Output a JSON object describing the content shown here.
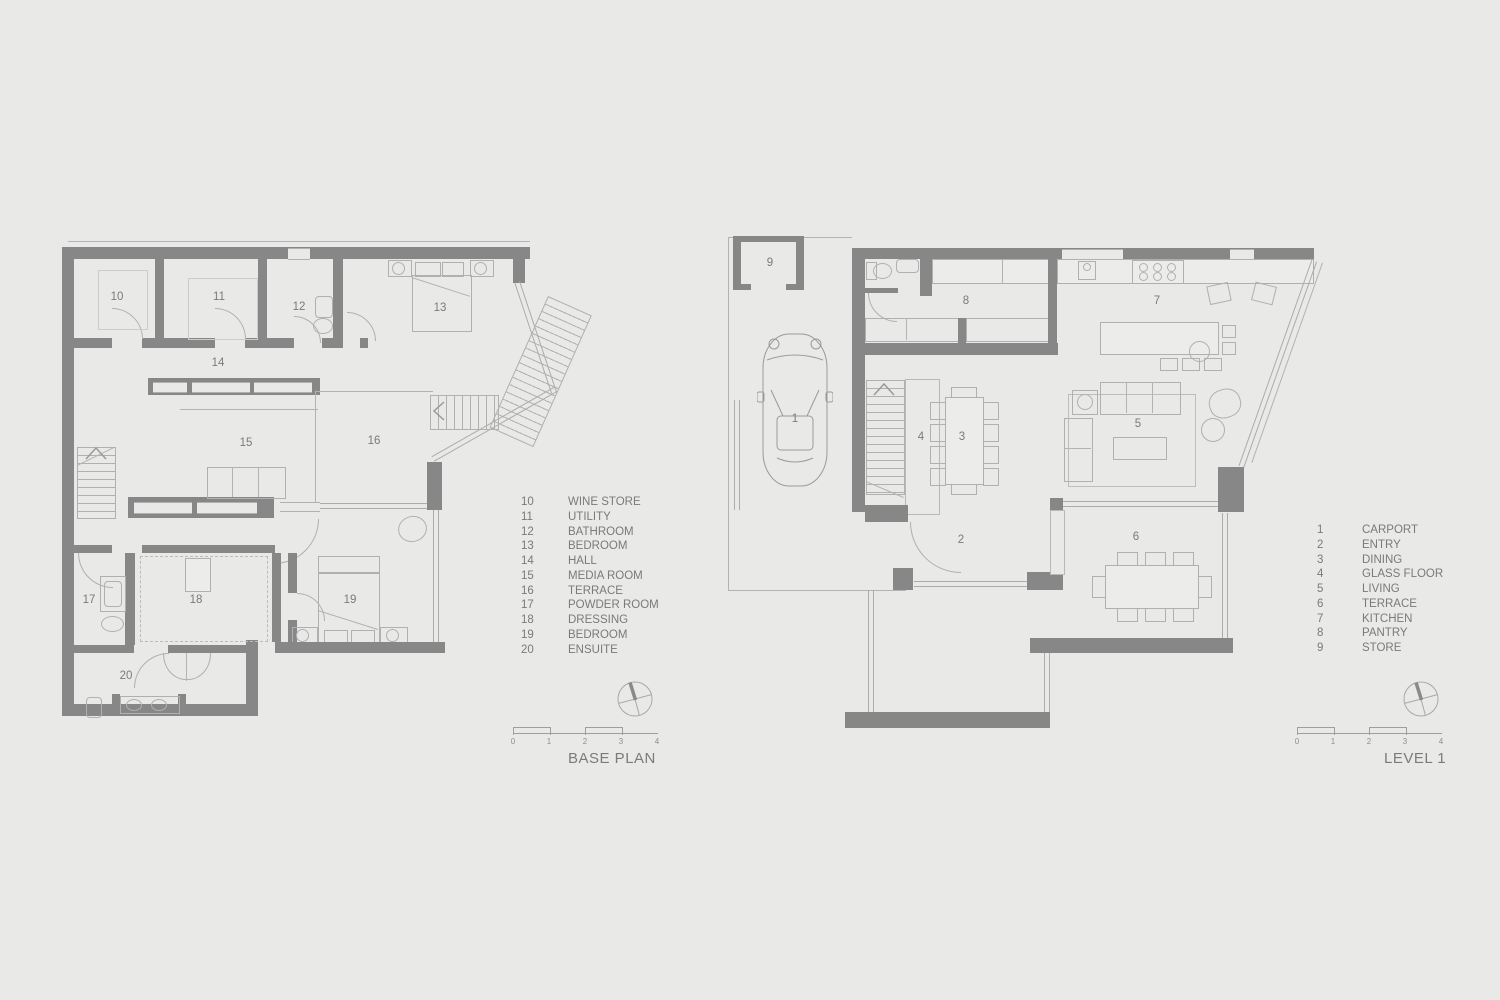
{
  "colors": {
    "background": "#e9e9e8",
    "wall": "#878787",
    "line": "#b0b0b0",
    "text": "#7a7a7a"
  },
  "plans": [
    {
      "title": "BASE PLAN",
      "legend": [
        {
          "num": "10",
          "label": "WINE STORE"
        },
        {
          "num": "11",
          "label": "UTILITY"
        },
        {
          "num": "12",
          "label": "BATHROOM"
        },
        {
          "num": "13",
          "label": "BEDROOM"
        },
        {
          "num": "14",
          "label": "HALL"
        },
        {
          "num": "15",
          "label": "MEDIA ROOM"
        },
        {
          "num": "16",
          "label": "TERRACE"
        },
        {
          "num": "17",
          "label": "POWDER ROOM"
        },
        {
          "num": "18",
          "label": "DRESSING"
        },
        {
          "num": "19",
          "label": "BEDROOM"
        },
        {
          "num": "20",
          "label": "ENSUITE"
        }
      ],
      "scale_ticks": [
        "0",
        "1",
        "2",
        "3",
        "4"
      ]
    },
    {
      "title": "LEVEL 1",
      "legend": [
        {
          "num": "1",
          "label": "CARPORT"
        },
        {
          "num": "2",
          "label": "ENTRY"
        },
        {
          "num": "3",
          "label": "DINING"
        },
        {
          "num": "4",
          "label": "GLASS FLOOR"
        },
        {
          "num": "5",
          "label": "LIVING"
        },
        {
          "num": "6",
          "label": "TERRACE"
        },
        {
          "num": "7",
          "label": "KITCHEN"
        },
        {
          "num": "8",
          "label": "PANTRY"
        },
        {
          "num": "9",
          "label": "STORE"
        }
      ],
      "scale_ticks": [
        "0",
        "1",
        "2",
        "3",
        "4"
      ]
    }
  ]
}
